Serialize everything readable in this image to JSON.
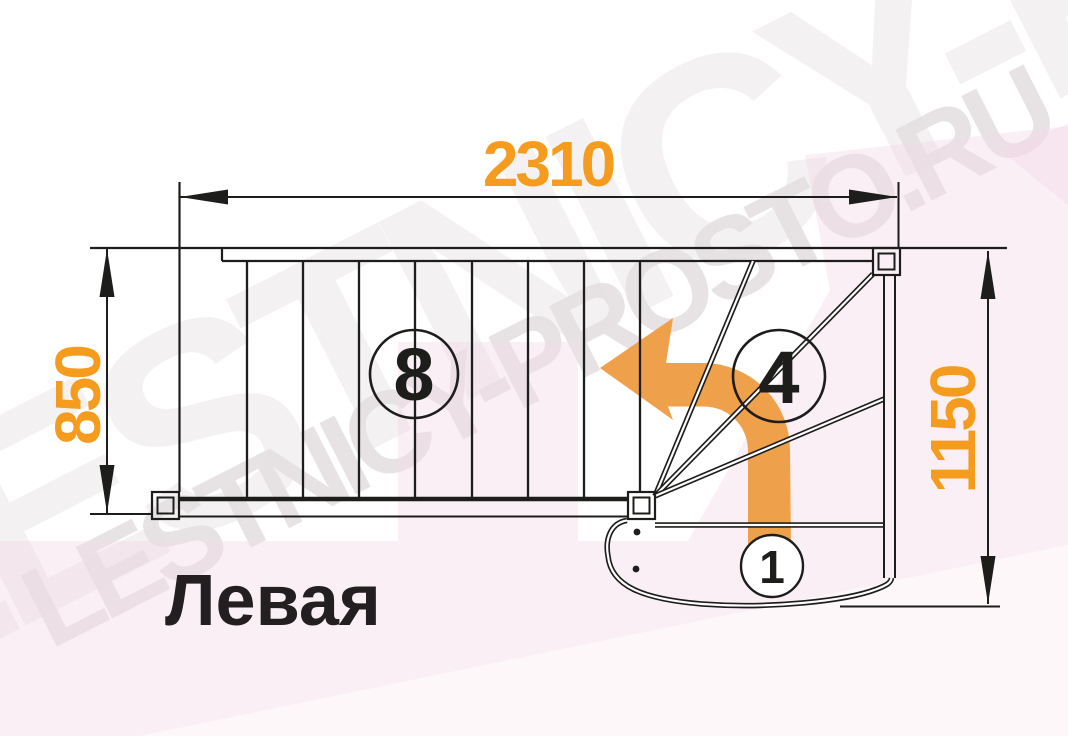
{
  "title": {
    "text": "Левая",
    "color": "#231F20"
  },
  "watermark": {
    "text": "LESTNICY-PROSTO.RU",
    "color": "#E6E2E4",
    "tint": "#F3D8E6"
  },
  "dimensions": {
    "color": "#F59C1E",
    "top": {
      "value": "2310"
    },
    "left": {
      "value": "850"
    },
    "right": {
      "value": "1150"
    }
  },
  "steps": {
    "label_color": "#1D1D1B",
    "straight_flight_label": "8",
    "winder_label": "4",
    "first_step_label": "1"
  },
  "arrow": {
    "color": "#EFA04B"
  }
}
